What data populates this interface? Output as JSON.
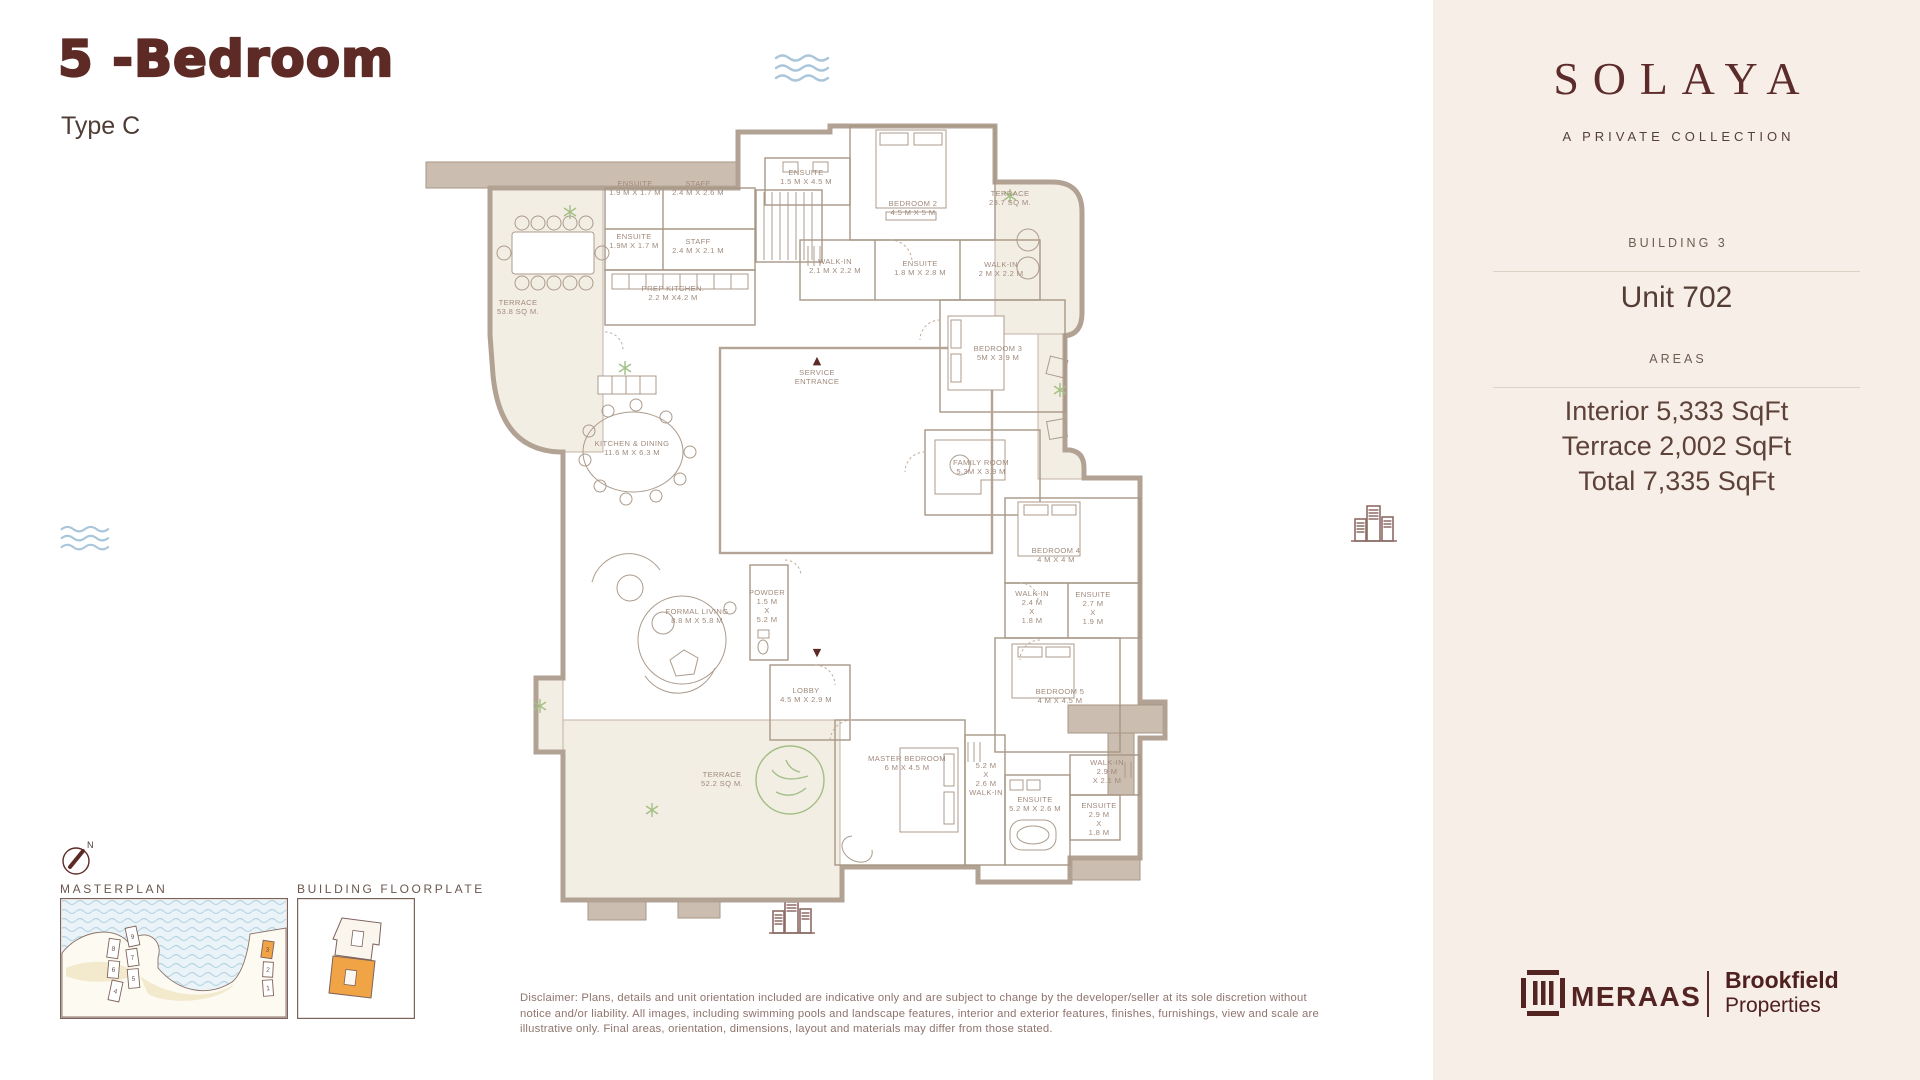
{
  "header": {
    "title": "5 -Bedroom",
    "subtitle": "Type C"
  },
  "sidebar": {
    "brand": {
      "name": "SOLAYA",
      "tagline": "A PRIVATE COLLECTION"
    },
    "building_label": "BUILDING 3",
    "unit_label": "Unit 702",
    "areas_label": "AREAS",
    "area_lines": [
      "Interior 5,333 SqFt",
      "Terrace 2,002 SqFt",
      "Total 7,335 SqFt"
    ],
    "logos": {
      "meraas": "MERAAS",
      "brookfield_line1": "Brookfield",
      "brookfield_line2": "Properties"
    }
  },
  "compass": {
    "n": "N"
  },
  "minimaps": {
    "masterplan": {
      "label": "MASTERPLAN",
      "buildings": [
        {
          "n": "8",
          "x": 48,
          "y": 41,
          "w": 11,
          "h": 19,
          "r": 8,
          "hl": false
        },
        {
          "n": "6",
          "x": 48,
          "y": 63,
          "w": 11,
          "h": 17,
          "r": 5,
          "hl": false
        },
        {
          "n": "4",
          "x": 50,
          "y": 83,
          "w": 11,
          "h": 20,
          "r": 12,
          "hl": false
        },
        {
          "n": "9",
          "x": 67,
          "y": 29,
          "w": 11,
          "h": 19,
          "r": -12,
          "hl": false
        },
        {
          "n": "7",
          "x": 67,
          "y": 51,
          "w": 11,
          "h": 17,
          "r": -8,
          "hl": false
        },
        {
          "n": "5",
          "x": 68,
          "y": 71,
          "w": 11,
          "h": 19,
          "r": -5,
          "hl": false
        },
        {
          "n": "3",
          "x": 202,
          "y": 43,
          "w": 11,
          "h": 17,
          "r": 8,
          "hl": true
        },
        {
          "n": "2",
          "x": 203,
          "y": 64,
          "w": 10,
          "h": 15,
          "r": 3,
          "hl": false
        },
        {
          "n": "1",
          "x": 203,
          "y": 82,
          "w": 10,
          "h": 16,
          "r": -4,
          "hl": false
        }
      ]
    },
    "floorplate": {
      "label": "BUILDING FLOORPLATE"
    }
  },
  "plan": {
    "markers": {
      "service_entrance": "▲",
      "main_entrance": "▼"
    },
    "room_labels": [
      {
        "x": 215,
        "y": 66,
        "lines": [
          "ENSUITE",
          "1.9 M X 1.7 M"
        ]
      },
      {
        "x": 278,
        "y": 66,
        "lines": [
          "STAFF",
          "2.4 M X 2.6 M"
        ]
      },
      {
        "x": 214,
        "y": 119,
        "lines": [
          "ENSUITE",
          "1.9M X 1.7 M"
        ]
      },
      {
        "x": 278,
        "y": 124,
        "lines": [
          "STAFF",
          "2.4 M X 2.1 M"
        ]
      },
      {
        "x": 253,
        "y": 171,
        "lines": [
          "PREP KITCHEN.",
          "2.2 M X4.2 M"
        ]
      },
      {
        "x": 98,
        "y": 185,
        "lines": [
          "TERRACE",
          "53.8 SQ M."
        ]
      },
      {
        "x": 386,
        "y": 55,
        "lines": [
          "ENSUITE",
          "1.5 M X 4.5 M"
        ]
      },
      {
        "x": 493,
        "y": 86,
        "lines": [
          "BEDROOM 2",
          "4.5 M X 5 M"
        ]
      },
      {
        "x": 590,
        "y": 76,
        "lines": [
          "TERRACE",
          "23.7 SQ M."
        ]
      },
      {
        "x": 415,
        "y": 144,
        "lines": [
          "WALK-IN",
          "2.1 M X 2.2 M"
        ]
      },
      {
        "x": 500,
        "y": 146,
        "lines": [
          "ENSUITE",
          "1.8 M X 2.8 M"
        ]
      },
      {
        "x": 581,
        "y": 147,
        "lines": [
          "WALK-IN",
          "2 M X 2.2 M"
        ]
      },
      {
        "x": 397,
        "y": 255,
        "lines": [
          "SERVICE",
          "ENTRANCE"
        ]
      },
      {
        "x": 578,
        "y": 231,
        "lines": [
          "BEDROOM 3",
          "5M X 3.9 M"
        ]
      },
      {
        "x": 561,
        "y": 345,
        "lines": [
          "FAMILY ROOM",
          "5.3M X 3.9 M"
        ]
      },
      {
        "x": 212,
        "y": 326,
        "lines": [
          "KITCHEN & DINING",
          "11.6 M X 6.3 M"
        ]
      },
      {
        "x": 277,
        "y": 494,
        "lines": [
          "FORMAL LIVING",
          "8.8 M X 5.8 M"
        ]
      },
      {
        "x": 347,
        "y": 475,
        "lines": [
          "POWDER",
          "1.5 M",
          "X",
          "5.2 M"
        ]
      },
      {
        "x": 386,
        "y": 573,
        "lines": [
          "LOBBY",
          "4.5 M X 2.9 M"
        ]
      },
      {
        "x": 302,
        "y": 657,
        "lines": [
          "TERRACE",
          "52.2 SQ M."
        ]
      },
      {
        "x": 487,
        "y": 641,
        "lines": [
          "MASTER BEDROOM",
          "6 M X 4.5 M"
        ]
      },
      {
        "x": 566,
        "y": 648,
        "lines": [
          "5.2 M",
          "X",
          "2.6 M",
          "WALK-IN"
        ]
      },
      {
        "x": 636,
        "y": 433,
        "lines": [
          "BEDROOM 4",
          "4 M X 4 M"
        ]
      },
      {
        "x": 612,
        "y": 476,
        "lines": [
          "WALK-IN",
          "2.4 M",
          "X",
          "1.8 M"
        ]
      },
      {
        "x": 673,
        "y": 477,
        "lines": [
          "ENSUITE",
          "2.7 M",
          "X",
          "1.9 M"
        ]
      },
      {
        "x": 640,
        "y": 574,
        "lines": [
          "BEDROOM 5",
          "4 M X 4.5 M"
        ]
      },
      {
        "x": 687,
        "y": 645,
        "lines": [
          "WALK-IN",
          "2.9 M",
          "X 2.1 M"
        ]
      },
      {
        "x": 615,
        "y": 682,
        "lines": [
          "ENSUITE",
          "5.2 M X 2.6 M"
        ]
      },
      {
        "x": 679,
        "y": 688,
        "lines": [
          "ENSUITE",
          "2.9 M",
          "X",
          "1.8 M"
        ]
      }
    ]
  },
  "disclaimer": "Disclaimer: Plans, details and unit orientation included are indicative only and are subject to change by the developer/seller at its sole discretion without notice and/or liability. All images, including swimming pools and landscape features, interior and exterior features, finishes, furnishings, view and scale are illustrative only. Final areas, orientation, dimensions, layout and materials may differ from those stated.",
  "colors": {
    "accent_maroon": "#5e2a25",
    "sidebar_bg": "#f7efe7",
    "highlight_orange": "#f0a445",
    "water_blue": "#e9f3f8",
    "wall": "#b2a294",
    "terrace_fill": "#f3eee4",
    "label": "#a18a7c"
  }
}
